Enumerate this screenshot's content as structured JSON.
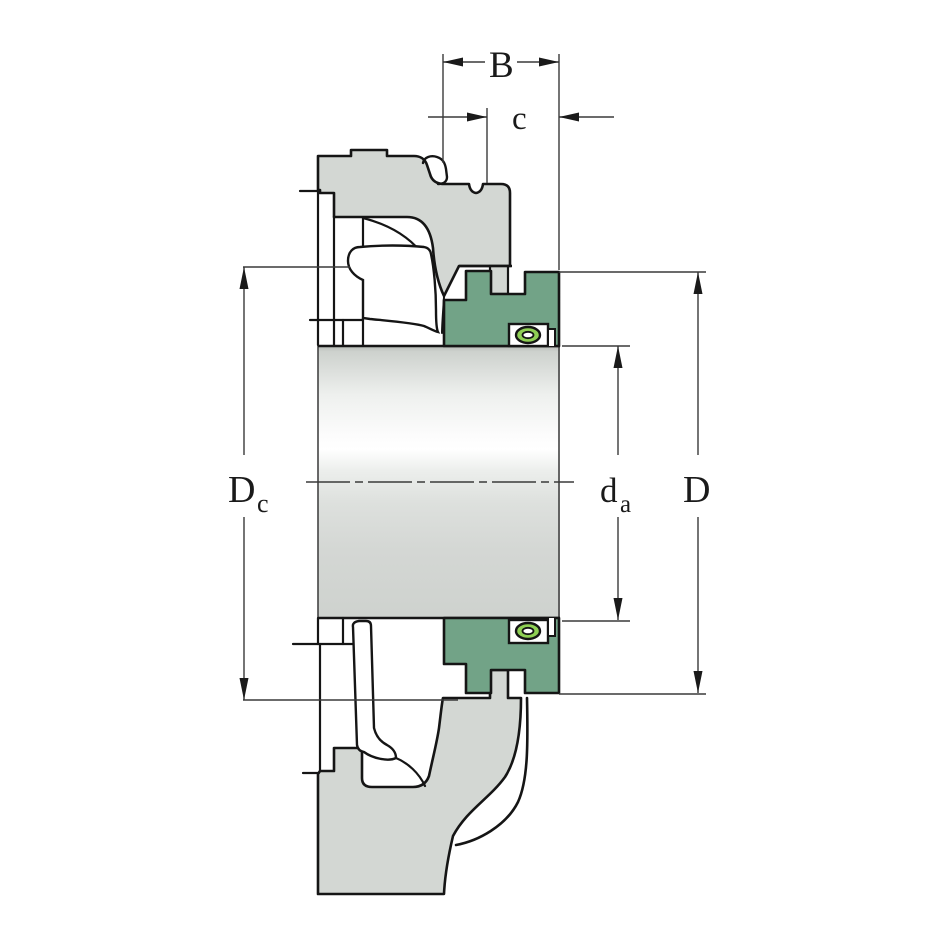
{
  "drawing": {
    "type": "bearing-unit-cross-section",
    "labels": {
      "insert_width": "B",
      "seal_width": "c",
      "recess_diameter_base": "D",
      "recess_diameter_sub": "c",
      "shaft_diameter_base": "d",
      "shaft_diameter_sub": "a",
      "outer_diameter": "D"
    },
    "colors": {
      "housing": "#d3d7d3",
      "seal": "#72a387",
      "oring": "#8fd054",
      "line": "#151515",
      "dim": "#3a3a3a",
      "background": "#ffffff"
    }
  }
}
